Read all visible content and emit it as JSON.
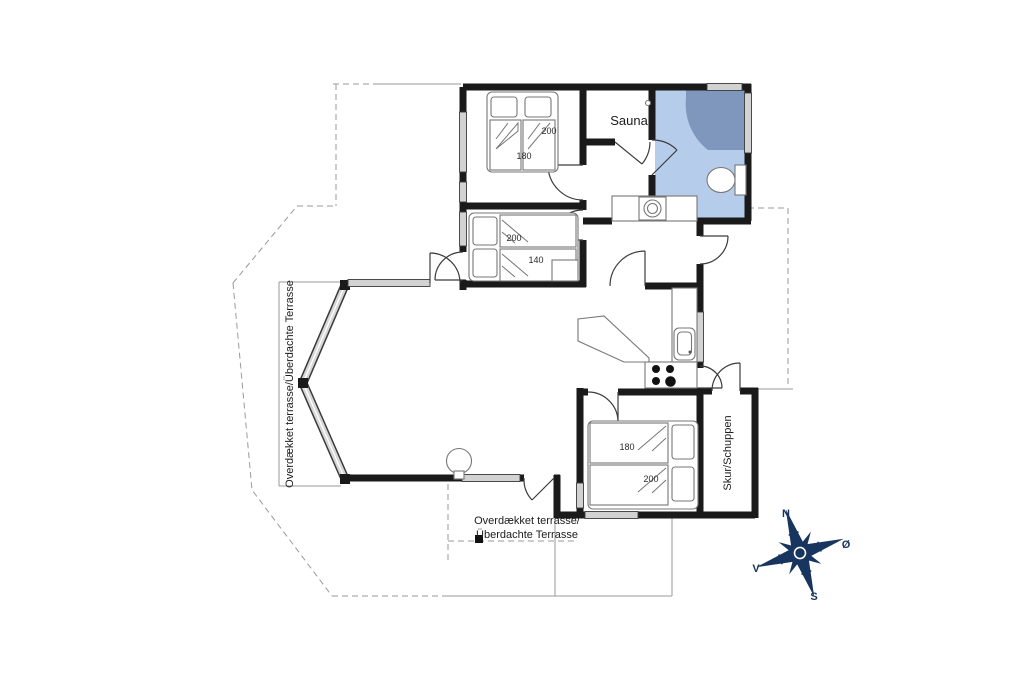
{
  "plan": {
    "rooms": {
      "sauna": "Sauna",
      "shed": "Skur/Schuppen",
      "terrace_west": "Overdækket terrasse/Überdachte Terrasse",
      "terrace_south_line1": "Overdækket terrasse/",
      "terrace_south_line2": "Überdachte Terrasse"
    },
    "beds": {
      "top_bedroom": {
        "length": "200",
        "width": "180"
      },
      "middle_bedroom": {
        "length": "200",
        "width": "140"
      },
      "bottom_bedroom": {
        "width": "180",
        "length": "200"
      }
    },
    "compass": {
      "n": "N",
      "e": "Ø",
      "s": "S",
      "v": "V"
    },
    "colors": {
      "wall": "#1a1a1a",
      "bathroom": "#b5cdea",
      "shower": "#8097bd",
      "compass": "#17355e"
    }
  }
}
